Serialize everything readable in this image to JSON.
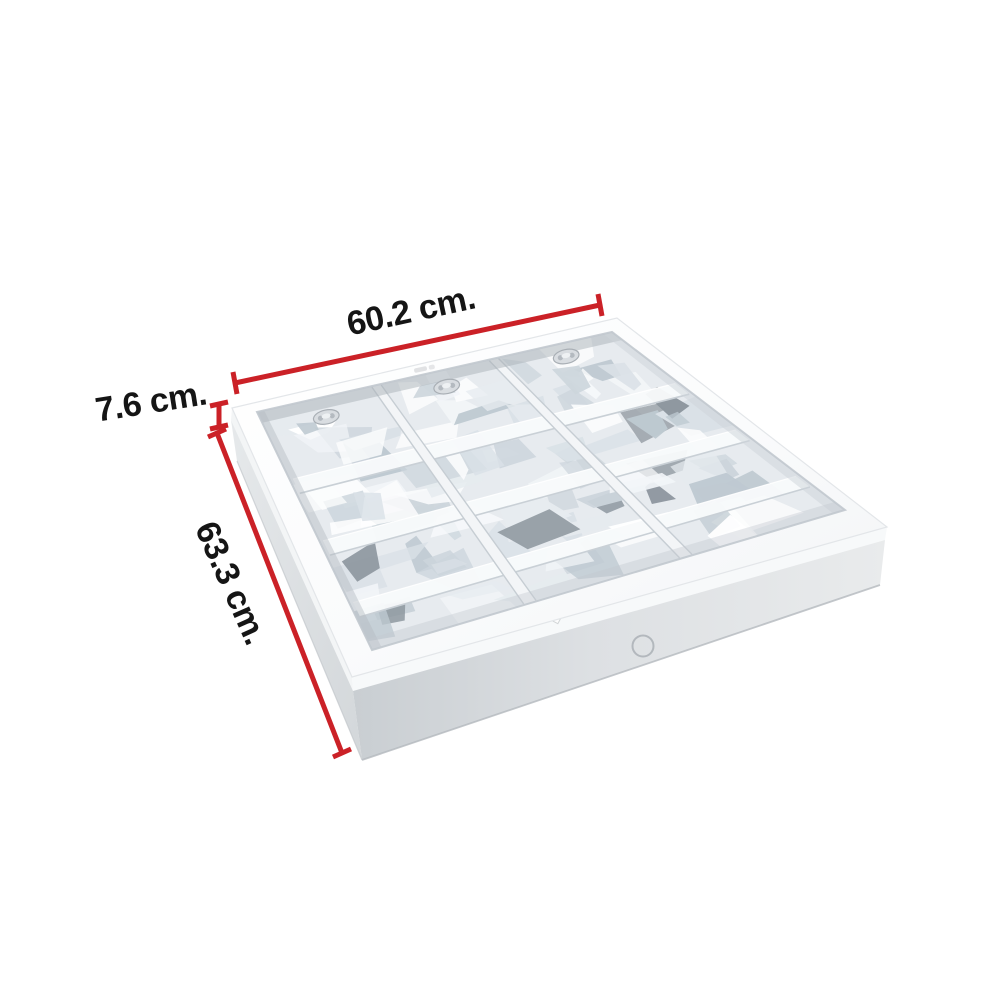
{
  "image": {
    "background_color": "#ffffff"
  },
  "annotations": {
    "accent_color": "#cb2127",
    "text_color": "#151515",
    "width": {
      "label": "60.2 cm."
    },
    "height": {
      "label": "7.6 cm."
    },
    "depth": {
      "label": "63.3 cm."
    }
  }
}
